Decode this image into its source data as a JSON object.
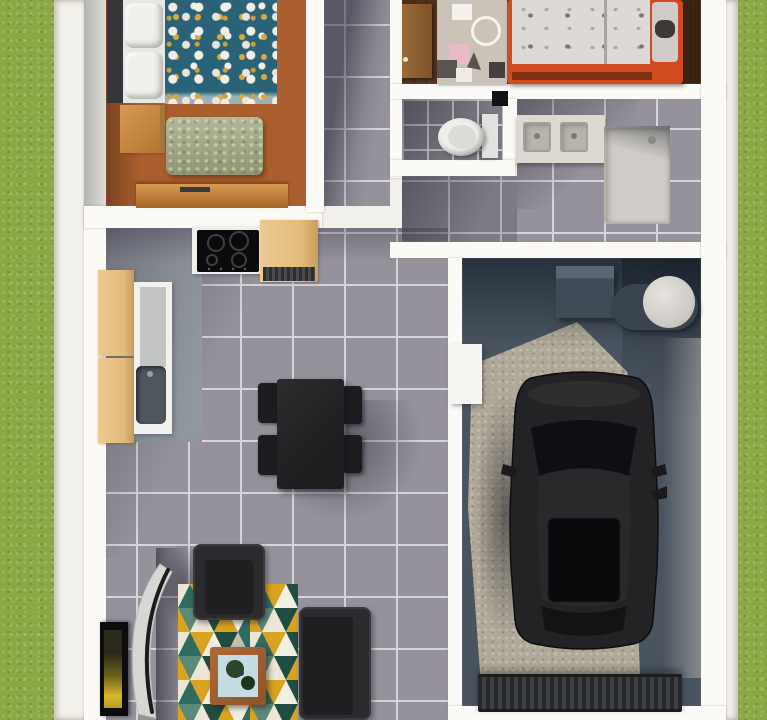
{
  "scene": {
    "title": "3D rendered floor plan, top-down view",
    "palette": {
      "grass": "#8CA845",
      "foundation": "#f2f0ea",
      "wall": "#fbfaf6",
      "tile": "#96929c",
      "tile_grout": "#d6d3da",
      "wood_warm": "#ab5e2e",
      "wood_dark": "#5a3a20",
      "kitchen_floor": "#9aa1a8",
      "garage_floor": "#4a5460",
      "garage_light_patch": "#b0a899",
      "accent_orange": "#d14b20",
      "duvet_teal": "#2a6378",
      "ottoman_sage": "#a9ae8c",
      "furniture_charcoal": "#2b2b2e",
      "cabinet_tan": "#e3bc7c",
      "rug_teal": "#2f6b5e",
      "rug_pine": "#214d40",
      "rug_gold": "#d9a31f",
      "rug_cream": "#ece6d4",
      "car_black": "#232325"
    },
    "rooms": {
      "master_bedroom": {
        "label": "Master bedroom"
      },
      "hallway": {
        "label": "Hallway"
      },
      "kids_bedroom": {
        "label": "Kids bedroom"
      },
      "wc": {
        "label": "WC"
      },
      "bathroom": {
        "label": "Bathroom"
      },
      "kitchen": {
        "label": "Kitchen"
      },
      "dining_area": {
        "label": "Dining area"
      },
      "living_room": {
        "label": "Living room"
      },
      "garage": {
        "label": "Garage"
      }
    },
    "furniture": {
      "double_bed": {
        "label": "Double bed with teal floral duvet",
        "pillow_count": 2
      },
      "nightstand": {
        "label": "Wooden nightstand"
      },
      "ottoman": {
        "label": "Sage green ottoman"
      },
      "dresser": {
        "label": "Wooden dresser"
      },
      "kids_bed": {
        "label": "Kids bed with orange frame"
      },
      "play_mat": {
        "label": "Kids play mat"
      },
      "room_door": {
        "label": "Open wooden door"
      },
      "toilet": {
        "label": "Toilet"
      },
      "vanity": {
        "label": "Double-sink vanity",
        "sink_count": 2
      },
      "shower": {
        "label": "Shower tray"
      },
      "cooktop": {
        "label": "Black cooktop",
        "burner_count": 4
      },
      "kitchen_cabinets": {
        "label": "Tan kitchen cabinets"
      },
      "kitchen_sink": {
        "label": "Kitchen sink"
      },
      "dining_table": {
        "label": "Dark dining table",
        "chair_count": 4
      },
      "armchair": {
        "label": "Charcoal armchair"
      },
      "sofa": {
        "label": "Charcoal sofa"
      },
      "coffee_table": {
        "label": "Coffee table with plants"
      },
      "area_rug": {
        "label": "Triangle-pattern area rug"
      },
      "tv": {
        "label": "TV leaning on wall"
      },
      "arc_lamp": {
        "label": "Curved floor lamp"
      },
      "car": {
        "label": "Black car parked in garage"
      },
      "water_heater": {
        "label": "Water heater unit"
      },
      "boiler_tank": {
        "label": "Round boiler tank"
      },
      "doormat": {
        "label": "Ribbed garage doormat"
      }
    }
  }
}
